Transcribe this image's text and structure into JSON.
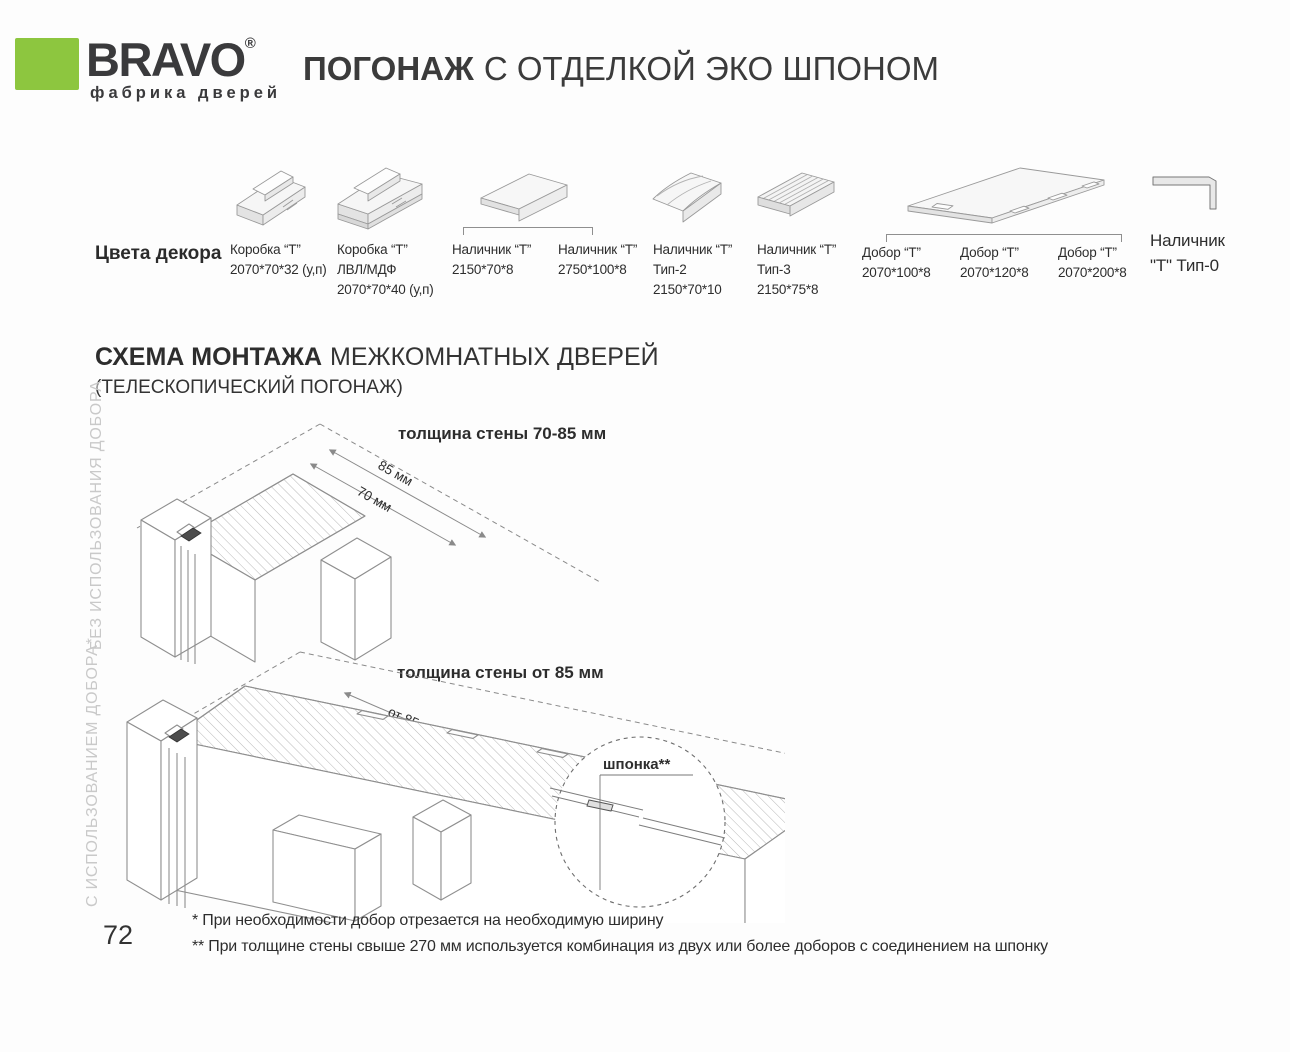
{
  "page": {
    "number": "72"
  },
  "header": {
    "brand": "BRAVO",
    "registered": "®",
    "tagline": "фабрика дверей",
    "title_bold": "ПОГОНАЖ",
    "title_rest": "С ОТДЕЛКОЙ ЭКО ШПОНОМ",
    "brand_green": "#8dc63f"
  },
  "products": {
    "section_label": "Цвета декора",
    "items": [
      {
        "id": "korobka-t",
        "lines": [
          "Коробка “Т”",
          "2070*70*32 (у,п)"
        ]
      },
      {
        "id": "korobka-t-lvl",
        "lines": [
          "Коробка “Т”",
          "ЛВЛ/МДФ",
          "2070*70*40 (у,п)"
        ]
      },
      {
        "id": "nalichnik-t-2150",
        "lines": [
          "Наличник “Т”",
          "2150*70*8"
        ]
      },
      {
        "id": "nalichnik-t-2750",
        "lines": [
          "Наличник “Т”",
          "2750*100*8"
        ]
      },
      {
        "id": "nalichnik-t-tip2",
        "lines": [
          "Наличник “Т”",
          "Тип-2",
          "2150*70*10"
        ]
      },
      {
        "id": "nalichnik-t-tip3",
        "lines": [
          "Наличник “Т”",
          "Тип-3",
          "2150*75*8"
        ]
      },
      {
        "id": "dobor-t-100",
        "lines": [
          "Добор “Т”",
          "2070*100*8"
        ]
      },
      {
        "id": "dobor-t-120",
        "lines": [
          "Добор “Т”",
          "2070*120*8"
        ]
      },
      {
        "id": "dobor-t-200",
        "lines": [
          "Добор “Т”",
          "2070*200*8"
        ]
      },
      {
        "id": "nalichnik-t-tip0",
        "lines": [
          "Наличник",
          "\"Т\" Тип-0"
        ]
      }
    ]
  },
  "scheme": {
    "title_bold": "СХЕМА МОНТАЖА",
    "title_rest": "МЕЖКОМНАТНЫХ ДВЕРЕЙ",
    "subtitle": "(ТЕЛЕСКОПИЧЕСКИЙ ПОГОНАЖ)",
    "diagram1": {
      "title": "толщина стены 70-85 мм",
      "dim_a": "85 мм",
      "dim_b": "70 мм",
      "side_label": "БЕЗ ИСПОЛЬЗОВАНИЯ ДОБОРА"
    },
    "diagram2": {
      "title": "толщина стены от 85 мм",
      "dim": "от 85 - 270 мм",
      "detail_label": "шпонка**",
      "side_label": "С ИСПОЛЬЗОВАНИЕМ ДОБОРА*"
    }
  },
  "footnotes": [
    "* При необходимости добор отрезается на необходимую ширину",
    "** При толщине стены свыше 270 мм используется комбинация из двух или более доборов с соединением на шпонку"
  ]
}
